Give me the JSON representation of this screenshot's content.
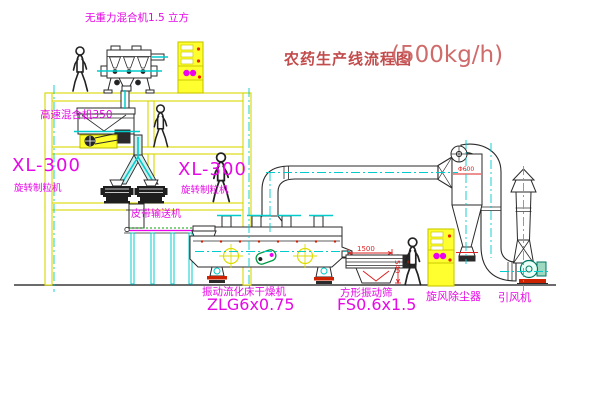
{
  "title": {
    "text": "农药生产线流程图",
    "capacity": "(500kg/h)"
  },
  "labels": {
    "mixer_top": "无重力混合机1.5 立方",
    "mixer_floor2": "高速混合机350",
    "granulator_left_model": "XL-300",
    "granulator_left_name": "旋转制粒机",
    "granulator_right_model": "XL-300",
    "granulator_right_name": "旋转制粒机",
    "belt_conveyor": "皮带输送机",
    "dryer_name": "振动流化床干燥机",
    "dryer_model": "ZLG6x0.75",
    "sieve_name": "方形振动筛",
    "sieve_model": "FS0.6x1.5",
    "cyclone_name": "旋风除尘器",
    "fan_name": "引风机"
  },
  "dimensions": {
    "sieve_length": "1500",
    "sieve_height": "540",
    "cyclone_diameter": "Φ600"
  },
  "colors": {
    "line_yellow": "#d8d800",
    "centerline_cyan": "#00cccc",
    "label_magenta": "#e608e6",
    "dimension_red": "#dd2222",
    "title_red": "#c8504f",
    "cabinet_fill": "#ffff30"
  }
}
